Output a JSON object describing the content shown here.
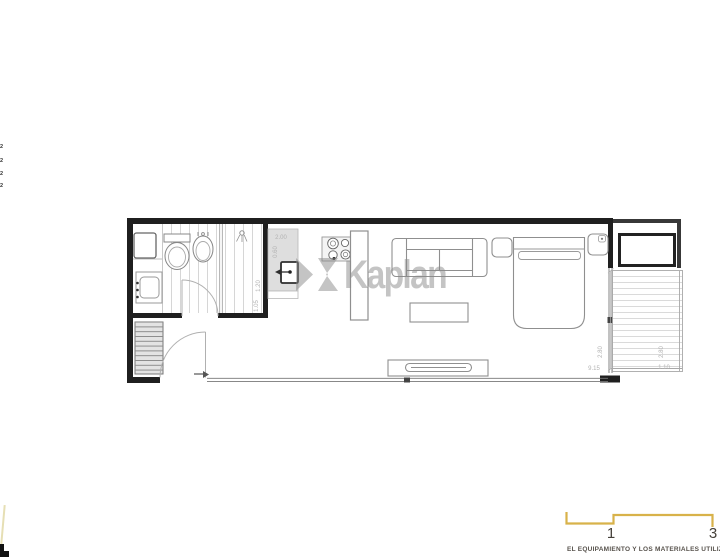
{
  "watermark": {
    "text": "Kaplan"
  },
  "page": {
    "left_edge_fragments": [
      "2",
      "2",
      "2",
      "2"
    ],
    "footer": {
      "page_number_left": "1",
      "page_number_right": "3",
      "caption": "EL EQUIPAMIENTO Y LOS MATERIALES UTILIZADOS S"
    }
  },
  "floor_plan": {
    "dimensions": {
      "kitchen_length": "2.00",
      "kitchen_depth": "0.60",
      "shower_width": "1.20",
      "shower_depth": "1.05",
      "main_length": "9.15",
      "main_window_height": "2.80",
      "terrace_width": "1.10",
      "terrace_height": "2.80"
    }
  },
  "colors": {
    "accent_gold": "#d8b24a",
    "wall_black": "#1f1f1f",
    "furniture_line": "#8f8f8f",
    "floor_stripe": "#d6d6d6",
    "counter_fill": "#dedede",
    "watermark_gray": "#c6c6c6",
    "dimension_gray": "#b3b3b3",
    "footer_text": "#57524c"
  }
}
